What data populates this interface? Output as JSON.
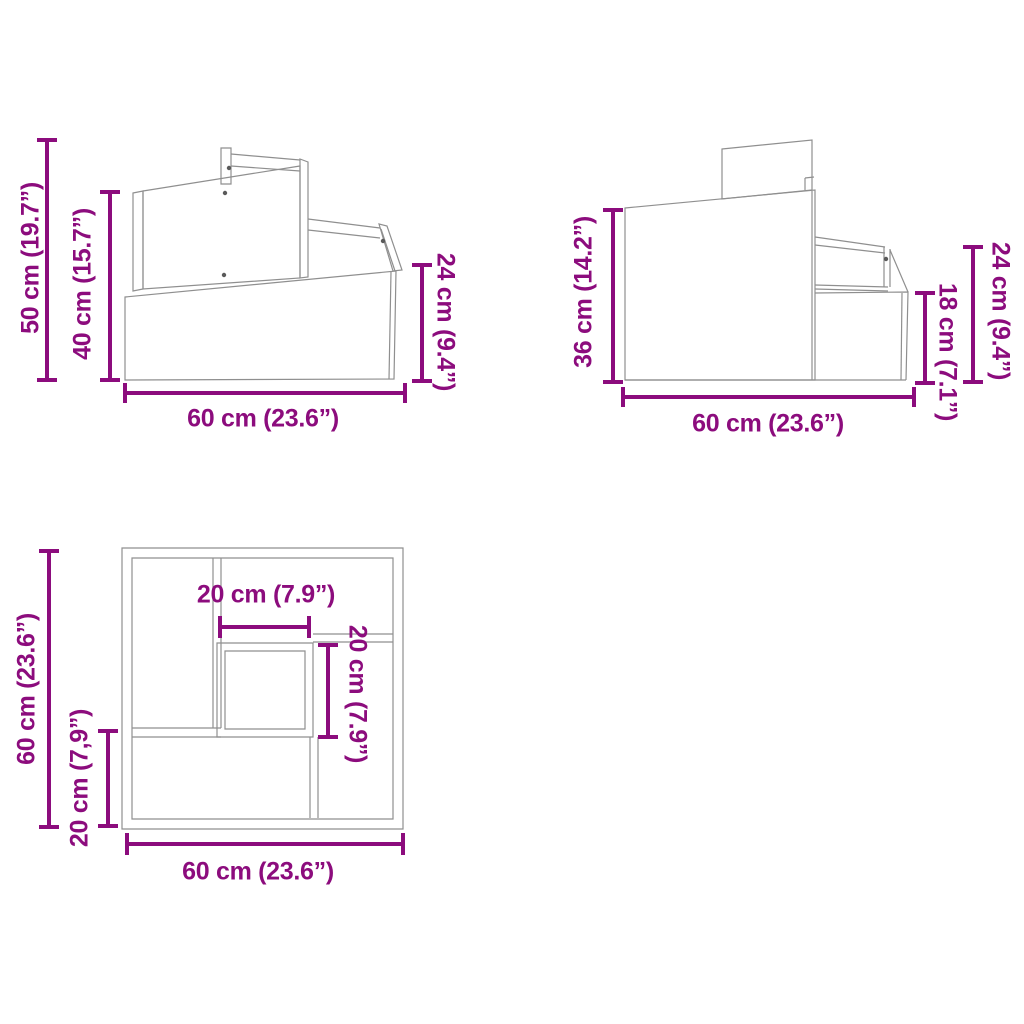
{
  "colors": {
    "dimension_accent": "#8C0C7D",
    "drawing_line": "#8f8f8f",
    "background": "#ffffff"
  },
  "diagram": {
    "description": "three-view product dimension drawing of two-step unit",
    "views": {
      "side_a": {
        "name": "side-view-left",
        "dims": {
          "total_height": "50 cm (19.7”)",
          "panel_height": "40 cm (15.7”)",
          "step_height": "24 cm (9.4”)",
          "width": "60 cm (23.6”)"
        }
      },
      "side_b": {
        "name": "side-view-right",
        "dims": {
          "front_height": "36 cm (14.2”)",
          "step_height": "18 cm (7.1”)",
          "rail_height": "24 cm (9.4”)",
          "width": "60 cm (23.6”)"
        }
      },
      "top": {
        "name": "top-view",
        "dims": {
          "depth": "60 cm (23.6”)",
          "lower_step_depth": "20 cm (7,9”)",
          "platform_width": "20 cm (7.9”)",
          "platform_depth": "20 cm (7.9”)",
          "width": "60 cm (23.6”)"
        }
      }
    }
  }
}
